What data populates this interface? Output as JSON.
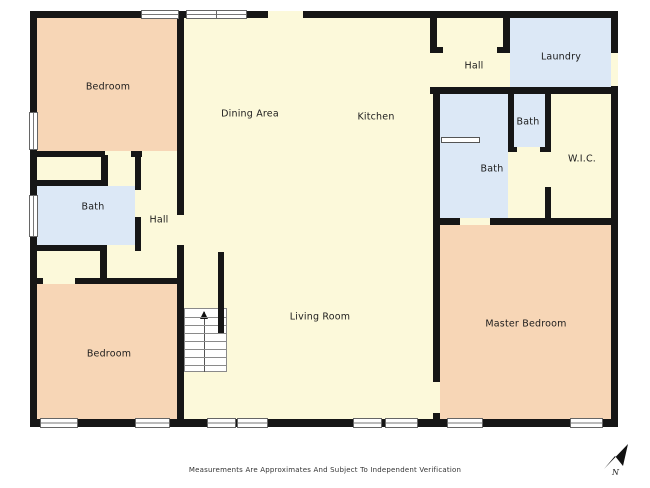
{
  "plan": {
    "rooms": {
      "bedroom_top": "Bedroom",
      "dining": "Dining Area",
      "kitchen": "Kitchen",
      "hall_top": "Hall",
      "laundry": "Laundry",
      "bath_small": "Bath",
      "bath_master": "Bath",
      "wic": "W.I.C.",
      "bath_left": "Bath",
      "hall_left": "Hall",
      "bedroom_bottom": "Bedroom",
      "living": "Living Room",
      "master_bedroom": "Master Bedroom"
    },
    "compass": "N",
    "colors": {
      "room_yellow": "#fcf9da",
      "room_peach": "#f7d6b6",
      "room_blue": "#dce8f6",
      "wall": "#161616",
      "window_frame": "#666666"
    }
  },
  "footer": {
    "disclaimer": "Measurements Are Approximates And Subject To Independent Verification"
  }
}
